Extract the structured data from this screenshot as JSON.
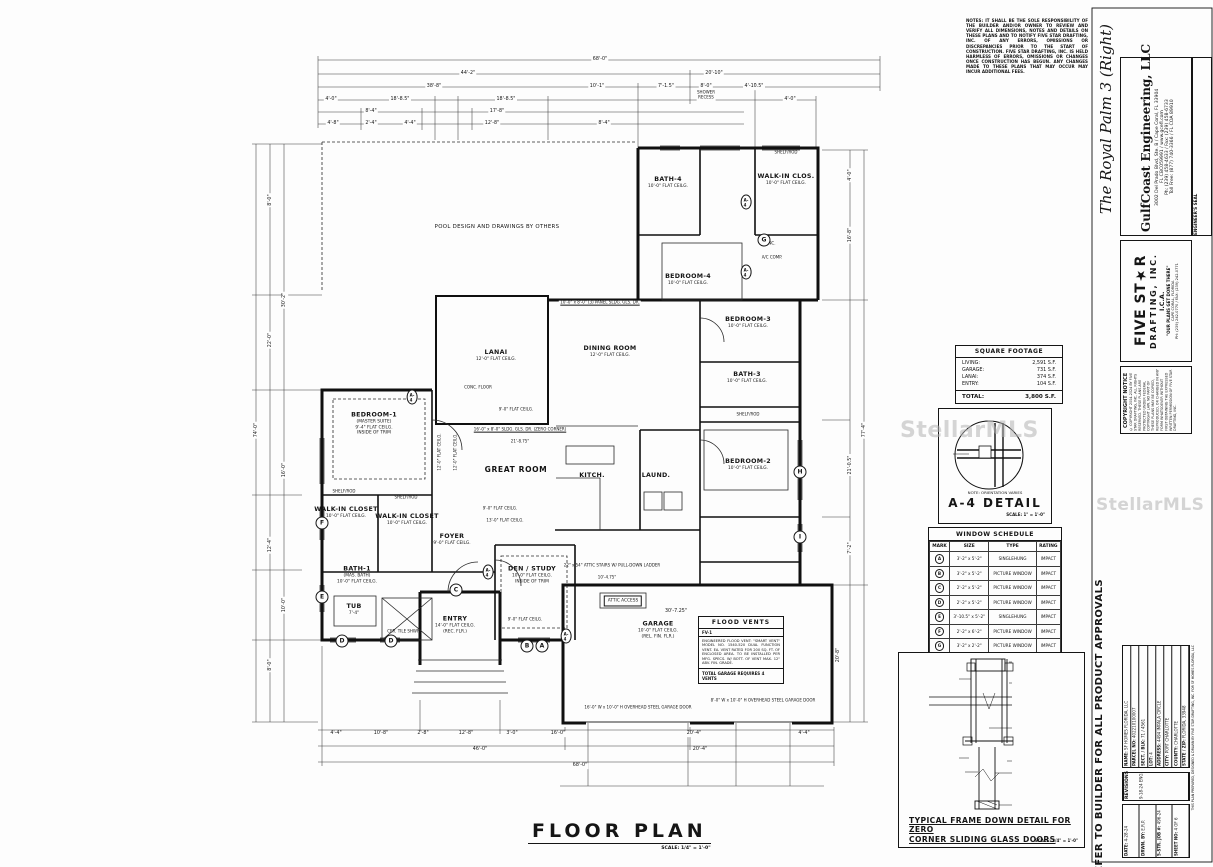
{
  "plan": {
    "title": "FLOOR PLAN",
    "scale": "SCALE: 1/4\" = 1'-0\"",
    "rooms": [
      {
        "n": "BATH-4",
        "s1": "10'-0\" FLAT CEILG.",
        "x": 668,
        "y": 183
      },
      {
        "n": "WALK-IN CLOS.",
        "s1": "10'-0\" FLAT CEILG.",
        "x": 786,
        "y": 180
      },
      {
        "n": "BEDROOM-4",
        "s1": "10'-0\" FLAT CEILG.",
        "x": 688,
        "y": 280
      },
      {
        "n": "BEDROOM-3",
        "s1": "10'-0\" FLAT CEILG.",
        "x": 748,
        "y": 323
      },
      {
        "n": "BATH-3",
        "s1": "10'-0\" FLAT CEILG.",
        "x": 747,
        "y": 378
      },
      {
        "n": "DINING ROOM",
        "s1": "12'-0\" FLAT CEILG.",
        "x": 610,
        "y": 352
      },
      {
        "n": "LANAI",
        "s1": "12'-0\" FLAT CEILG.",
        "x": 496,
        "y": 356
      },
      {
        "n": "BEDROOM-1",
        "s1": "(MASTER SUITE)",
        "s2": "9'-4\" FLAT CEILG.",
        "s3": "INSIDE OF TRIM",
        "x": 374,
        "y": 424
      },
      {
        "n": "GREAT ROOM",
        "x": 516,
        "y": 470,
        "cls": "big"
      },
      {
        "n": "BEDROOM-2",
        "s1": "10'-0\" FLAT CEILG.",
        "x": 748,
        "y": 465
      },
      {
        "n": "KITCH.",
        "x": 592,
        "y": 476
      },
      {
        "n": "LAUND.",
        "x": 656,
        "y": 476
      },
      {
        "n": "WALK-IN CLOSET",
        "s1": "10'-0\" FLAT CEILG.",
        "x": 346,
        "y": 513
      },
      {
        "n": "WALK-IN CLOSET",
        "s1": "10'-0\" FLAT CEILG.",
        "x": 407,
        "y": 520
      },
      {
        "n": "FOYER",
        "s1": "9'-0\" FLAT CEILG.",
        "x": 452,
        "y": 540
      },
      {
        "n": "DEN / STUDY",
        "s1": "10'-0\" FLAT CEILG.",
        "s2": "INSIDE OF TRIM",
        "x": 532,
        "y": 575
      },
      {
        "n": "BATH-1",
        "s1": "(MAS. BATH)",
        "s2": "10'-0\" FLAT CEILG.",
        "x": 357,
        "y": 575
      },
      {
        "n": "ENTRY",
        "s1": "14'-0\" FLAT CEILG.",
        "s2": "(REC. FLR.)",
        "x": 455,
        "y": 625
      },
      {
        "n": "GARAGE",
        "s1": "10'-0\" FLAT CEILG.",
        "s2": "(REL. FIN. FLR.)",
        "x": 658,
        "y": 630
      },
      {
        "n": "TUB",
        "s1": "7'-4\"",
        "x": 354,
        "y": 610
      }
    ],
    "annos": [
      {
        "t": "68'-0\"",
        "x": 600,
        "y": 60,
        "cls": "dim"
      },
      {
        "t": "44'-2\"",
        "x": 468,
        "y": 74,
        "cls": "dim"
      },
      {
        "t": "20'-10\"",
        "x": 714,
        "y": 74,
        "cls": "dim"
      },
      {
        "t": "38'-8\"",
        "x": 434,
        "y": 87,
        "cls": "dim"
      },
      {
        "t": "10'-1\"",
        "x": 597,
        "y": 87,
        "cls": "dim"
      },
      {
        "t": "7'-1.5\"",
        "x": 666,
        "y": 87,
        "cls": "dim"
      },
      {
        "t": "8'-0\"",
        "x": 706,
        "y": 87,
        "cls": "dim"
      },
      {
        "t": "4'-10.5\"",
        "x": 754,
        "y": 87,
        "cls": "dim"
      },
      {
        "t": "SHOWER",
        "x": 706,
        "y": 93,
        "cls": "sm dim"
      },
      {
        "t": "RECESS",
        "x": 706,
        "y": 98,
        "cls": "sm dim"
      },
      {
        "t": "4'-0\"",
        "x": 331,
        "y": 100,
        "cls": "dim"
      },
      {
        "t": "18'-8.5\"",
        "x": 400,
        "y": 100,
        "cls": "dim"
      },
      {
        "t": "18'-8.5\"",
        "x": 506,
        "y": 100,
        "cls": "dim"
      },
      {
        "t": "4'-0\"",
        "x": 790,
        "y": 100,
        "cls": "dim"
      },
      {
        "t": "8'-4\"",
        "x": 371,
        "y": 112,
        "cls": "dim"
      },
      {
        "t": "17'-8\"",
        "x": 497,
        "y": 112,
        "cls": "dim"
      },
      {
        "t": "4'-8\"",
        "x": 333,
        "y": 124,
        "cls": "dim"
      },
      {
        "t": "2'-4\"",
        "x": 371,
        "y": 124,
        "cls": "dim"
      },
      {
        "t": "4'-4\"",
        "x": 410,
        "y": 124,
        "cls": "dim"
      },
      {
        "t": "12'-8\"",
        "x": 492,
        "y": 124,
        "cls": "dim"
      },
      {
        "t": "8'-4\"",
        "x": 604,
        "y": 124,
        "cls": "dim"
      },
      {
        "t": "74'-0\"",
        "x": 257,
        "y": 430,
        "r": -90,
        "cls": "dim"
      },
      {
        "t": "8'-0\"",
        "x": 271,
        "y": 200,
        "r": -90,
        "cls": "dim"
      },
      {
        "t": "22'-0\"",
        "x": 271,
        "y": 340,
        "r": -90,
        "cls": "dim"
      },
      {
        "t": "30'-2\"",
        "x": 285,
        "y": 300,
        "r": -90,
        "cls": "dim"
      },
      {
        "t": "16'-0\"",
        "x": 285,
        "y": 470,
        "r": -90,
        "cls": "dim"
      },
      {
        "t": "12'-4\"",
        "x": 271,
        "y": 545,
        "r": -90,
        "cls": "dim"
      },
      {
        "t": "10'-0\"",
        "x": 285,
        "y": 605,
        "r": -90,
        "cls": "dim"
      },
      {
        "t": "8'-0\"",
        "x": 271,
        "y": 665,
        "r": -90,
        "cls": "dim"
      },
      {
        "t": "77'-4\"",
        "x": 865,
        "y": 430,
        "r": -90,
        "cls": "dim"
      },
      {
        "t": "4'-0\"",
        "x": 851,
        "y": 175,
        "r": -90,
        "cls": "dim"
      },
      {
        "t": "16'-8\"",
        "x": 851,
        "y": 235,
        "r": -90,
        "cls": "dim"
      },
      {
        "t": "21'-0.5\"",
        "x": 851,
        "y": 465,
        "r": -90,
        "cls": "dim"
      },
      {
        "t": "7'-2\"",
        "x": 851,
        "y": 548,
        "r": -90,
        "cls": "dim"
      },
      {
        "t": "20'-8\"",
        "x": 839,
        "y": 655,
        "r": -90,
        "cls": "dim"
      },
      {
        "t": "30'-7.25\"",
        "x": 676,
        "y": 612,
        "cls": "dim"
      },
      {
        "t": "4'-4\"",
        "x": 336,
        "y": 734,
        "cls": "dim"
      },
      {
        "t": "10'-8\"",
        "x": 381,
        "y": 734,
        "cls": "dim"
      },
      {
        "t": "2'-8\"",
        "x": 423,
        "y": 734,
        "cls": "dim"
      },
      {
        "t": "12'-8\"",
        "x": 466,
        "y": 734,
        "cls": "dim"
      },
      {
        "t": "3'-0\"",
        "x": 512,
        "y": 734,
        "cls": "dim"
      },
      {
        "t": "16'-0\"",
        "x": 558,
        "y": 734,
        "cls": "dim"
      },
      {
        "t": "20'-4\"",
        "x": 694,
        "y": 734,
        "cls": "dim"
      },
      {
        "t": "4'-4\"",
        "x": 804,
        "y": 734,
        "cls": "dim"
      },
      {
        "t": "46'-0\"",
        "x": 480,
        "y": 750,
        "cls": "dim"
      },
      {
        "t": "20'-4\"",
        "x": 700,
        "y": 750,
        "cls": "dim"
      },
      {
        "t": "68'-0\"",
        "x": 580,
        "y": 766,
        "cls": "dim"
      },
      {
        "t": "POOL DESIGN AND DRAWINGS BY OTHERS",
        "x": 497,
        "y": 227,
        "cls": "md"
      },
      {
        "t": "CONC. FLOOR",
        "x": 478,
        "y": 388,
        "cls": "sm"
      },
      {
        "t": "SHELF/ROD",
        "x": 344,
        "y": 492,
        "cls": "sm"
      },
      {
        "t": "SHELF/ROD",
        "x": 406,
        "y": 498,
        "cls": "sm"
      },
      {
        "t": "SHELF/ROD",
        "x": 786,
        "y": 153,
        "cls": "sm"
      },
      {
        "t": "SHELF/ROD",
        "x": 748,
        "y": 415,
        "cls": "sm"
      },
      {
        "t": "CER. TILE SHWR.",
        "x": 404,
        "y": 632,
        "cls": "sm"
      },
      {
        "t": "ATTIC ACCESS",
        "x": 623,
        "y": 601,
        "cls": "bx"
      },
      {
        "t": "A/C COMP.",
        "x": 772,
        "y": 258,
        "cls": "sm"
      },
      {
        "t": "CONC.",
        "x": 769,
        "y": 244,
        "cls": "sm"
      },
      {
        "t": "16'-0\" x 8'-0\" SLDG. GLS. DR. (ZERO CORNER)",
        "x": 520,
        "y": 430,
        "cls": "sm u dim"
      },
      {
        "t": "10'-0\" x 8'-0\" (3) PANEL SLDG. GLS. DR.",
        "x": 600,
        "y": 303,
        "cls": "sm u dim"
      },
      {
        "t": "22\" x 54\" ATTIC STAIRS W/ PULL-DOWN LADDER",
        "x": 612,
        "y": 566,
        "cls": "sm"
      },
      {
        "t": "10'-4.75\"",
        "x": 607,
        "y": 578,
        "cls": "sm dim"
      },
      {
        "t": "9'-0\" FLAT CEILG.",
        "x": 516,
        "y": 410,
        "cls": "sm"
      },
      {
        "t": "21'-8.75\"",
        "x": 520,
        "y": 442,
        "cls": "sm dim"
      },
      {
        "t": "9'-0\" FLAT CEILG.",
        "x": 500,
        "y": 509,
        "cls": "sm"
      },
      {
        "t": "13'-0\" FLAT CEILG.",
        "x": 505,
        "y": 521,
        "cls": "sm"
      },
      {
        "t": "12'-0\" FLAT CEILG.",
        "x": 440,
        "y": 452,
        "r": -90,
        "cls": "sm"
      },
      {
        "t": "12'-0\" FLAT CEILG.",
        "x": 456,
        "y": 452,
        "r": -90,
        "cls": "sm"
      },
      {
        "t": "9'-0\" FLAT CEILG.",
        "x": 525,
        "y": 620,
        "cls": "sm"
      },
      {
        "t": "16'-0\" W x 10'-0\" H OVERHEAD STEEL GARAGE DOOR",
        "x": 638,
        "y": 708,
        "cls": "sm dim"
      },
      {
        "t": "8'-0\" W x 10'-0\" H OVERHEAD STEEL GARAGE DOOR",
        "x": 763,
        "y": 701,
        "cls": "sm dim"
      }
    ],
    "markers": [
      {
        "t": "A",
        "x": 542,
        "y": 646
      },
      {
        "t": "B",
        "x": 527,
        "y": 646
      },
      {
        "t": "C",
        "x": 456,
        "y": 590
      },
      {
        "t": "D",
        "x": 342,
        "y": 641
      },
      {
        "t": "D",
        "x": 391,
        "y": 641
      },
      {
        "t": "E",
        "x": 322,
        "y": 597
      },
      {
        "t": "F",
        "x": 322,
        "y": 523
      },
      {
        "t": "G",
        "x": 764,
        "y": 240
      },
      {
        "t": "H",
        "x": 800,
        "y": 472
      },
      {
        "t": "I",
        "x": 800,
        "y": 537
      }
    ],
    "a4tags": [
      {
        "t": "A-4",
        "x": 746,
        "y": 202
      },
      {
        "t": "A-4",
        "x": 746,
        "y": 272
      },
      {
        "t": "A-4",
        "x": 488,
        "y": 572
      },
      {
        "t": "A-4",
        "x": 566,
        "y": 636
      },
      {
        "t": "A-4",
        "x": 412,
        "y": 397
      }
    ]
  },
  "sqft": {
    "title": "SQUARE FOOTAGE",
    "rows": [
      {
        "l": "LIVING:",
        "v": "2,591 S.F."
      },
      {
        "l": "GARAGE:",
        "v": "731 S.F."
      },
      {
        "l": "LANAI:",
        "v": "374 S.F."
      },
      {
        "l": "ENTRY:",
        "v": "104 S.F."
      }
    ],
    "total_label": "TOTAL:",
    "total_value": "3,800 S.F."
  },
  "a4": {
    "note": "NOTE: ORIENTATION VARIES",
    "title": "A-4 DETAIL",
    "scale": "SCALE: 1\" = 1'-0\"",
    "labels": [
      {
        "t": "C.B.S. WALL",
        "x": 1002,
        "y": 434,
        "cls": "sm"
      },
      {
        "t": "C.B.S. WALL",
        "x": 967,
        "y": 448,
        "cls": "sm"
      },
      {
        "t": "GARAGE DOOR",
        "x": 1024,
        "y": 457,
        "cls": "sm dim"
      },
      {
        "t": "1/2\" DRYWALL OVER",
        "x": 992,
        "y": 472,
        "cls": "sm"
      },
      {
        "t": "1x2 P.T. FURR.",
        "x": 992,
        "y": 477,
        "cls": "sm"
      },
      {
        "t": "1'-8\"",
        "x": 950,
        "y": 453,
        "r": -90,
        "cls": "sm"
      }
    ]
  },
  "winsched": {
    "title": "WINDOW SCHEDULE",
    "headers": [
      "MARK",
      "SIZE",
      "TYPE",
      "RATING"
    ],
    "rows": [
      [
        "A",
        "3'-2\" x 5'-2\"",
        "SINGLEHUNG",
        "IMPACT"
      ],
      [
        "B",
        "3'-2\" x 5'-2\"",
        "PICTURE WINDOW",
        "IMPACT"
      ],
      [
        "C",
        "2'-2\" x 5'-2\"",
        "PICTURE WINDOW",
        "IMPACT"
      ],
      [
        "D",
        "2'-2\" x 5'-2\"",
        "PICTURE WINDOW",
        "IMPACT"
      ],
      [
        "E",
        "3'-10.5\" x 5'-2\"",
        "SINGLEHUNG",
        "IMPACT"
      ],
      [
        "F",
        "2'-2\" x 6'-2\"",
        "PICTURE WINDOW",
        "IMPACT"
      ],
      [
        "G",
        "3'-2\" x 2'-2\"",
        "PICTURE WINDOW",
        "IMPACT"
      ],
      [
        "H",
        "6'-4\" x 5'-2\"",
        "HORIZ. ROLLING",
        "IMPACT"
      ],
      [
        "I",
        "2'-2\" x 3'-2\"",
        "PICTURE WINDOW",
        "IMPACT"
      ]
    ]
  },
  "flood": {
    "title": "FLOOD VENTS",
    "mark": "FV-1",
    "body": "ENGINEERED FLOOD VENT: \"SMART VENT\" MODEL NO. 1540-520 DUAL FUNCTION VENT. EA. VENT RATED FOR 200 SQ. FT. OF ENCLOSED AREA. TO BE INSTALLED PER MFG. SPECS. W/ BOTT. OF VENT MAX. 12\" ABV. FIN. GRADE.",
    "foot": "TOTAL GARAGE REQUIRES 4 VENTS"
  },
  "frame": {
    "title1": "TYPICAL FRAME DOWN DETAIL FOR ZERO",
    "title2": "CORNER SLIDING GLASS DOORS",
    "scale": "SCALE: 3/4\" = 1'-0\"",
    "callouts": [
      {
        "t": "2x SOLID WOOD BLOCKING",
        "x": 1013,
        "y": 661,
        "cls": "cll"
      },
      {
        "t": "H2.5A (TYPICAL)",
        "x": 1013,
        "y": 682,
        "cls": "cll"
      },
      {
        "t": "ROOF TRUSSES",
        "x": 1013,
        "y": 703,
        "cls": "cll"
      },
      {
        "t": "2\"x6\" OR 2\"x10\" S.Y.P.",
        "x": 1013,
        "y": 727,
        "cls": "cll"
      },
      {
        "t": "WOOD \"LEG\" (TYPICAL)",
        "x": 1013,
        "y": 732,
        "cls": "cll"
      },
      {
        "t": "ROOF TRUSS BOTT. CHORD",
        "x": 1013,
        "y": 760,
        "cls": "cll"
      },
      {
        "t": "WRAP WITH 1/2\" PLYWOOD",
        "x": 1013,
        "y": 772,
        "cls": "cll"
      },
      {
        "t": "DBL. 2x S.Y.P. BD. PLATES",
        "x": 1013,
        "y": 806,
        "cls": "cll"
      },
      {
        "t": "ROOF TRUSS",
        "x": 957,
        "y": 676,
        "cls": "clr"
      },
      {
        "t": "TOP CHORD",
        "x": 957,
        "y": 681,
        "cls": "clr"
      },
      {
        "t": "H2.5A (TYPICAL)",
        "x": 957,
        "y": 757,
        "cls": "clr"
      },
      {
        "t": "HTS20",
        "x": 963,
        "y": 771,
        "cls": "clr"
      }
    ]
  },
  "notes": "NOTES: IT SHALL BE THE SOLE RESPONSIBILITY OF THE BUILDER AND/OR OWNER TO REVIEW AND VERIFY ALL DIMENSIONS, NOTES AND DETAILS ON THESE PLANS AND TO NOTIFY FIVE STAR DRAFTING, INC. OF ANY ERRORS, OMISSIONS OR DISCREPANCIES PRIOR TO THE START OF CONSTRUCTION. FIVE STAR DRAFTING, INC. IS HELD HARMLESS OF ERRORS, OMISSIONS OR CHANGES ONCE CONSTRUCTION HAS BEGUN. ANY CHANGES MADE TO THESE PLANS THAT MAY OCCUR MAY INCUR ADDITIONAL FEES.",
  "strip": {
    "series_title": "The Royal Palm 3 (Right)",
    "engineer": {
      "name": "GulfCoast Engineering, LLC",
      "addr": "3002 Del Prado Blvd, Ste. B / Cape Coral, FL 33904",
      "lic": "FL CBC059991 / www.gcefl.com",
      "phone": "Ph: (239) 458-4633 / Fax: (239) 458-6733",
      "tollfree": "Toll Free: (877) 740-3366 / FL COA 89910",
      "seal": "ENGINEER'S SEAL"
    },
    "drafter": {
      "brand": "FIVE ST★R",
      "brand2": "DRAFTING, INC.",
      "ica": "I.C.A.",
      "tag": "\"OUR PLANS GET DONE THERE\"",
      "line1": "CAPE CORAL, FLORIDA",
      "line2": "PH: (239) 242-0770 / FAX: (239) 242-0771"
    },
    "copyright": {
      "header": "COPYRIGHT NOTICE",
      "body": "© COPYRIGHT 2004-2024 BY FIVE STAR DRAFTING, INC. ALL RIGHTS RESERVED. THESE PLANS ARE PROTECTED UNDER FEDERAL COPYRIGHT LAW. NO PART OF THESE PLANS MAY BE COPIED, REPRODUCED, OR CHANGED IN ANY FORM WHATSOEVER WITHOUT FIRST OBTAINING THE EXPRESSED WRITTEN PERMISSION OF FIVE STAR DRAFTING, INC."
    },
    "refer": "REFER TO BUILDER FOR ALL PRODUCT APPROVALS",
    "project": [
      {
        "l": "NAME:",
        "v": "SF HOMES FLORIDA, LLC"
      },
      {
        "l": "PARCEL NO:",
        "v": "402210100007"
      },
      {
        "l": "SECT. / BLK:",
        "v": "71 / 4561"
      },
      {
        "l": "LOT:",
        "v": "4"
      },
      {
        "l": "ADDRESS:",
        "v": "4494 IMPALA CIRCLE"
      },
      {
        "l": "CITY:",
        "v": "PORT CHARLOTTE"
      },
      {
        "l": "COUNTY:",
        "v": "CHARLOTTE"
      },
      {
        "l": "STATE / ZIP:",
        "v": "FLORIDA, 33948"
      }
    ],
    "micro_note": "THIS PLAN PREPARED, DESIGNED & DRAWN BY FIVE STAR DRAFTING, INC. FOR SF HOMES FLORIDA, LLC",
    "revisions": {
      "header": "REVISIONS",
      "rows": [
        {
          "l": "",
          "v": "9-18-24 ENG. REV. LIV. & PKG. DR."
        }
      ]
    },
    "sheetinfo": [
      {
        "l": "DATE:",
        "v": "4-28-24"
      },
      {
        "l": "DRWN. BY:",
        "v": "E.R.P."
      },
      {
        "l": "5-STR. JOB #:",
        "v": "496-24"
      },
      {
        "l": "SHEET NO:",
        "v": "4 OF 6"
      }
    ]
  },
  "watermark": "StellarMLS"
}
